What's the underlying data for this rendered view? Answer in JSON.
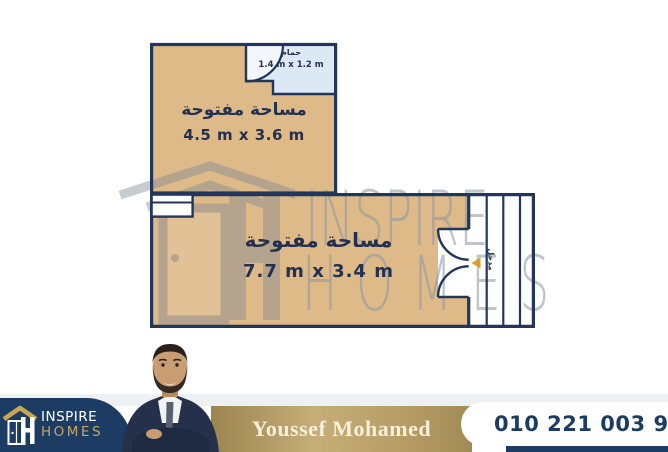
{
  "floor_plan": {
    "upper_room": {
      "label": "مساحة مفتوحة",
      "dimensions": "4.5 m x 3.6 m"
    },
    "bathroom": {
      "label": "حمام",
      "dimensions": "1.4 m x 1.2 m"
    },
    "lower_room": {
      "label": "مساحة مفتوحة",
      "dimensions": "7.7 m x 3.4 m"
    },
    "entrance_label": "مدخل"
  },
  "watermark": {
    "brand_line1": "INSPIRE",
    "brand_line2": "HOMES"
  },
  "footer": {
    "logo": {
      "brand_line1": "INSPIRE",
      "brand_line2": "HOMES"
    },
    "agent_name": "Youssef Mohamed",
    "phone_number": "010 221 003 97"
  },
  "icons": {
    "footer_logo": "house-logo-icon",
    "watermark_logo": "house-logo-watermark-icon",
    "phone": "phone-icon",
    "entry_marker": "entry-arrow-icon"
  },
  "colors": {
    "wall_navy": "#22365c",
    "room_tan": "#deba89",
    "bathroom_blue": "#dce9f4",
    "brand_navy": "#1d3c63",
    "brand_gold": "#b59c64",
    "logo_gold": "#c9a54e",
    "cream_text": "#f7efdb",
    "entry_arrow_gold": "#d6a02c",
    "watermark_gray": "#8b94a2"
  }
}
